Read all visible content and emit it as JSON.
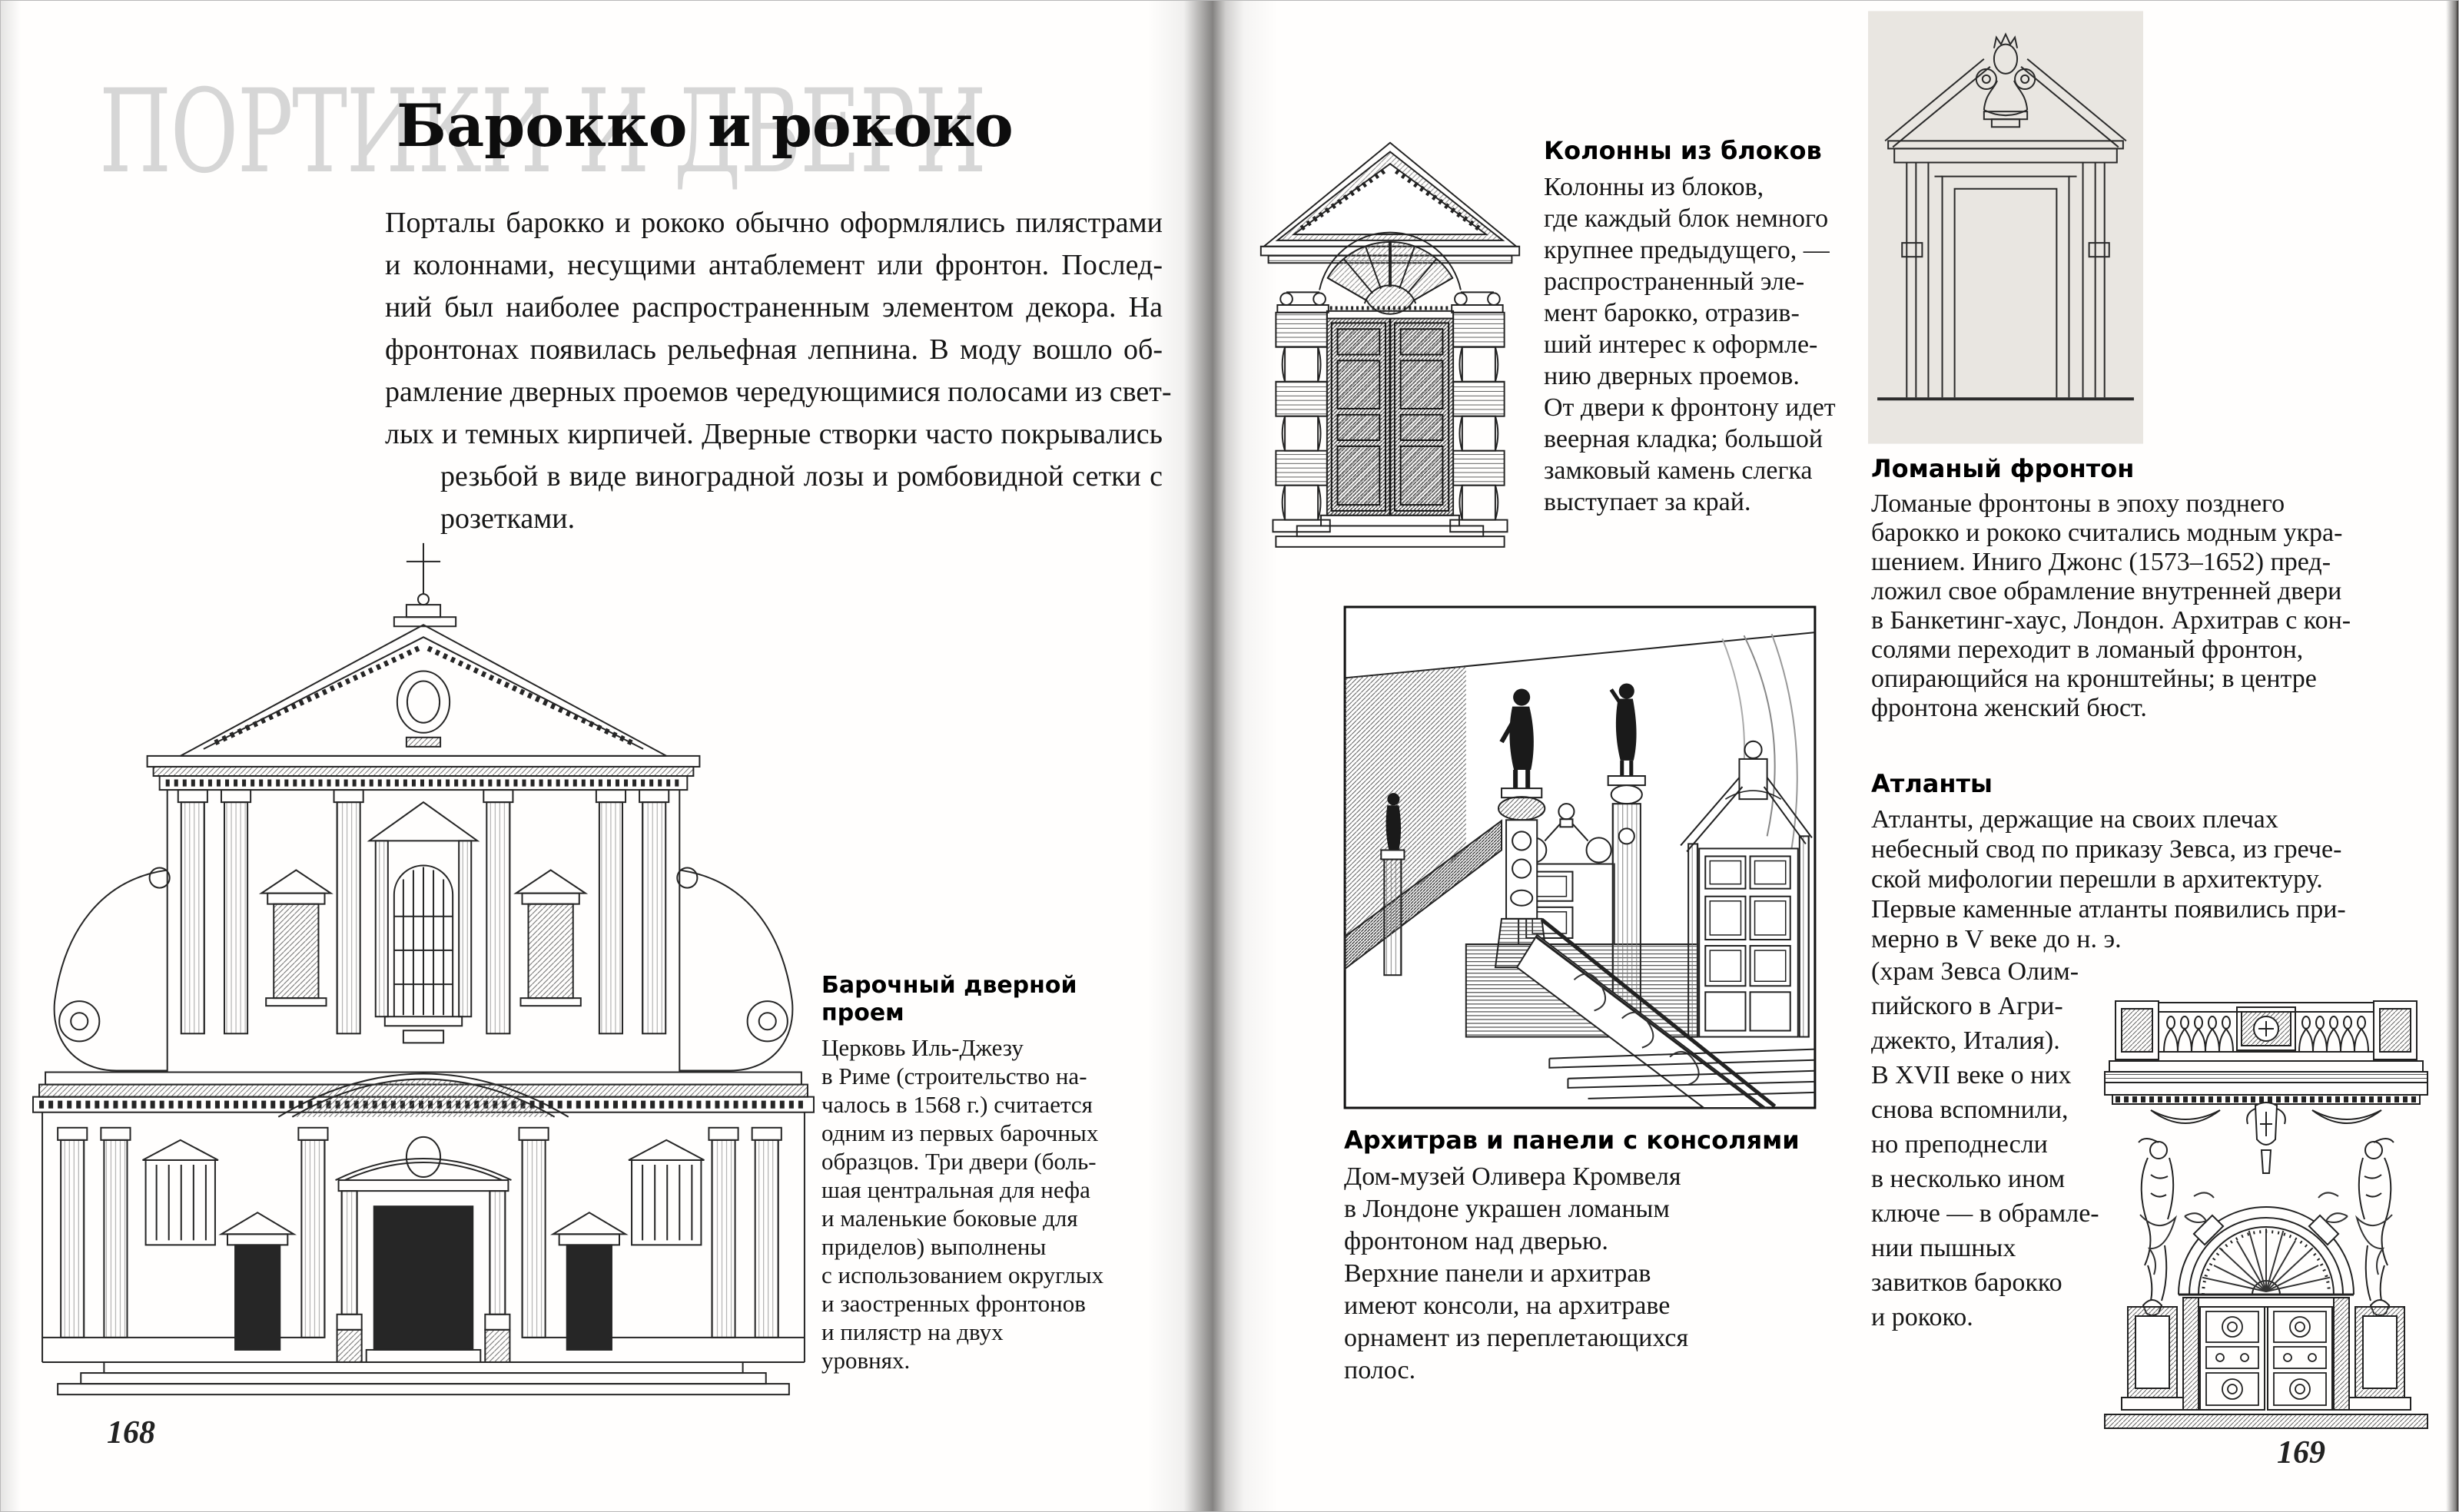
{
  "book": {
    "left_page": {
      "page_number": "168",
      "watermark": "ПОРТИКИ И ДВЕРИ",
      "title": "Барокко и рококо",
      "intro_lines": [
        "Порталы барокко и рококо обычно оформлялись пилястрами",
        "и колоннами, несущими антаблемент или фронтон. Послед-",
        "ний был наиболее распространенным элементом декора. На",
        "фронтонах появилась рельефная лепнина. В моду вошло об-",
        "рамление дверных проемов чередующимися полосами из свет-",
        "лых и темных кирпичей. Дверные створки часто покрывались",
        "резьбой в виде виноградной лозы и ромбовидной сетки с",
        "розетками."
      ],
      "figure_caption": {
        "heading": "Барочный дверной проем",
        "lines": [
          "Церковь Иль-Джезу",
          "в Риме (строительство на-",
          "чалось в 1568 г.) считается",
          "одним из первых барочных",
          "образцов. Три двери (боль-",
          "шая центральная для нефа",
          "и маленькие боковые для",
          "приделов) выполнены",
          "с использованием округлых",
          "и заостренных фронтонов",
          "и пилястр на двух",
          "уровнях."
        ]
      }
    },
    "right_page": {
      "page_number": "169",
      "sections": {
        "block_columns": {
          "heading": "Колонны из блоков",
          "lines": [
            "Колонны из блоков,",
            "где каждый блок немного",
            "крупнее предыдущего, —",
            "распространенный эле-",
            "мент барокко, отразив-",
            "ший интерес к оформле-",
            "нию дверных проемов.",
            "От двери к фронтону идет",
            "веерная кладка; большой",
            "замковый камень слегка",
            "выступает за край."
          ]
        },
        "broken_pediment": {
          "heading": "Ломаный фронтон",
          "lines": [
            "Ломаные фронтоны в эпоху позднего",
            "барокко и рококо считались модным укра-",
            "шением. Иниго Джонс (1573–1652) пред-",
            "ложил свое обрамление внутренней двери",
            "в Банкетинг-хаус, Лондон. Архитрав с кон-",
            "солями переходит в ломаный фронтон,",
            "опирающийся на кронштейны; в центре",
            "фронтона женский бюст."
          ]
        },
        "architrave": {
          "heading": "Архитрав и панели с консолями",
          "lines": [
            "Дом-музей Оливера Кромвеля",
            "в Лондоне украшен ломаным",
            "фронтоном над дверью.",
            "Верхние панели и архитрав",
            "имеют консоли, на архитраве",
            "орнамент из переплетающихся",
            "полос."
          ]
        },
        "atlantes": {
          "heading": "Атланты",
          "lines_wide": [
            "Атланты, держащие на своих плечах",
            "небесный свод по приказу Зевса, из грече-",
            "ской мифологии перешли в архитектуру.",
            "Первые каменные атланты появились при-",
            "мерно в V веке до н. э."
          ],
          "lines_narrow": [
            "(храм Зевса Олим-",
            "пийского в Агри-",
            "джекто, Италия).",
            "В XVII веке о них",
            "снова вспомнили,",
            "но преподнесли",
            "в несколько ином",
            "ключе — в обрамле-",
            "нии пышных",
            "завитков барокко",
            "и рококо."
          ]
        }
      }
    }
  }
}
